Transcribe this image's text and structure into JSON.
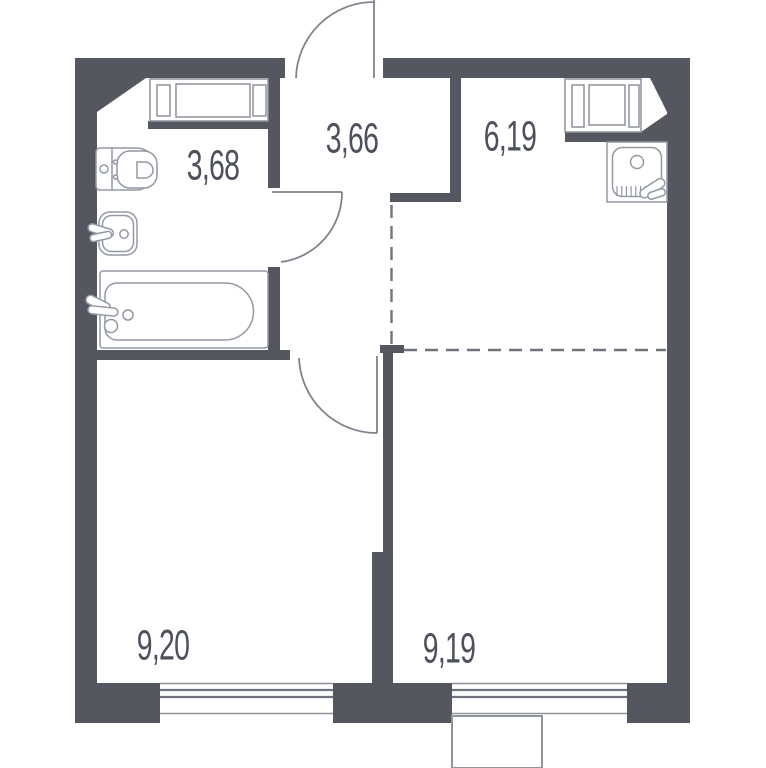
{
  "plan": {
    "title": "Apartment floor plan",
    "rooms": [
      {
        "id": "bathroom",
        "area": "3,68"
      },
      {
        "id": "hallway",
        "area": "3,66"
      },
      {
        "id": "kitchen-living",
        "area": "6,19"
      },
      {
        "id": "room-left",
        "area": "9,20"
      },
      {
        "id": "room-right",
        "area": "9,19"
      }
    ],
    "colors": {
      "wall": "#54575F",
      "outline": "#8E939C",
      "door_line": "#7E838D",
      "dashed_line": "#6F747E",
      "label_text": "#4D515B",
      "background": "#FFFFFF"
    },
    "fixtures": [
      "toilet",
      "washbasin",
      "bathtub",
      "kitchen-sink",
      "entrance-door",
      "bathroom-door",
      "room-door",
      "window-left",
      "window-right",
      "shaft-blocks",
      "ac-basket"
    ]
  }
}
